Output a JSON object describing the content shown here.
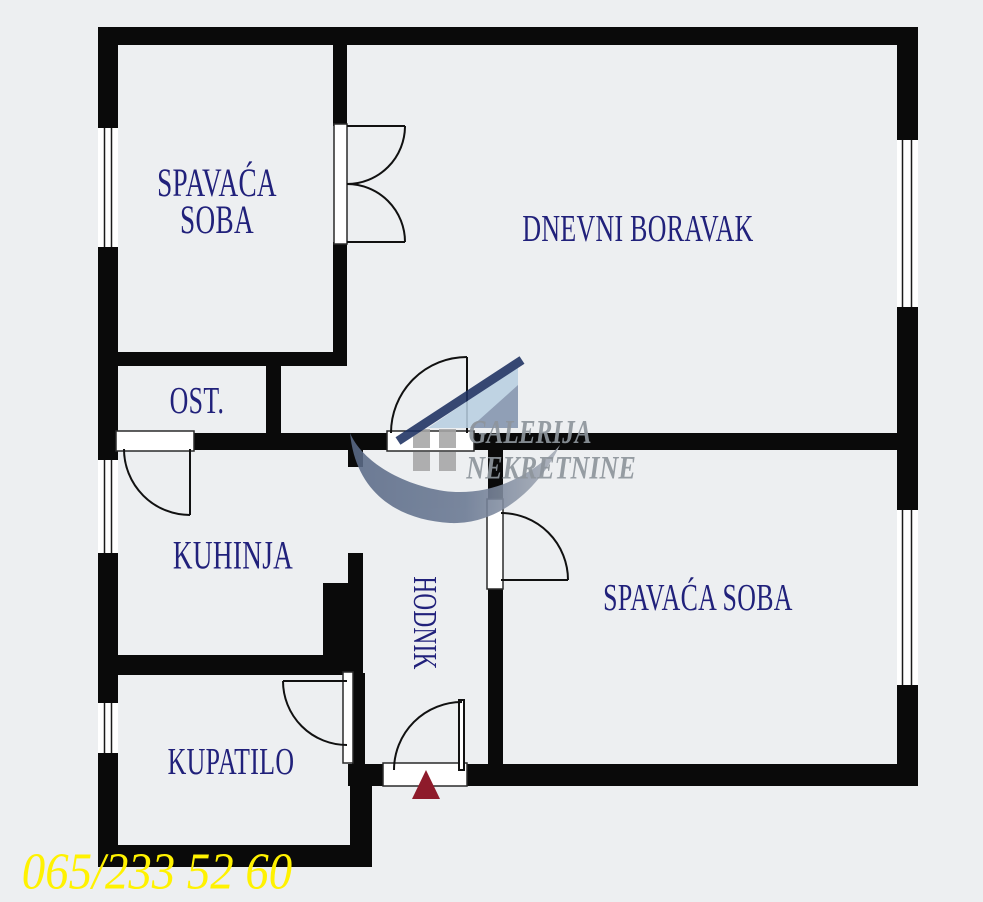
{
  "floor_plan": {
    "rooms": {
      "bedroom_top": {
        "line1": "SPAVAĆA",
        "line2": "SOBA"
      },
      "living_room": {
        "label": "DNEVNI BORAVAK"
      },
      "storage": {
        "label": "OST."
      },
      "kitchen": {
        "label": "KUHINJA"
      },
      "hallway": {
        "label": "HODNIK"
      },
      "bedroom_right": {
        "label": "SPAVAĆA SOBA"
      },
      "bathroom": {
        "label": "KUPATILO"
      }
    },
    "watermark": {
      "line1": "GALERIJA",
      "line2": "NEKRETNINE"
    },
    "contact": {
      "phone": "065/233 52 60"
    },
    "colors": {
      "wall": "#0a0a0a",
      "floor": "#edeff1",
      "room_label": "#21217b",
      "phone": "#fff200",
      "entrance_arrow": "#8e1b2b",
      "watermark_text": "#8e959c",
      "logo_navy": "#1d3061",
      "logo_light_blue": "#b9d0e2",
      "logo_slate": "#5d6d8a",
      "logo_squares": "#a6a6a6"
    }
  }
}
